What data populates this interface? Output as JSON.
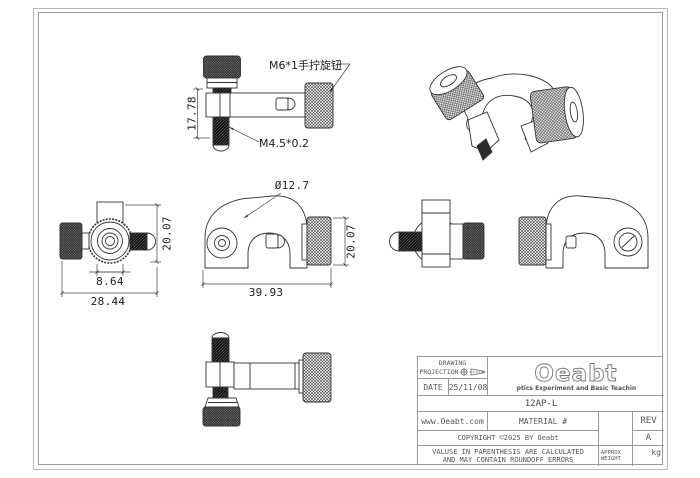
{
  "sheet": {
    "colors": {
      "line": "#333333",
      "frame": "#9a9a9a",
      "titleblock_text": "#555555"
    }
  },
  "drawing": {
    "callouts": {
      "thumb_screw": "M6*1手拧旋钮",
      "set_screw": "M4.5*0.2",
      "bore_diameter": "Ø12.7"
    },
    "dimensions": {
      "side_height": "17.78",
      "top_height": "20.07",
      "top_hub_width": "8.64",
      "top_total_width": "28.44",
      "front_knob_height": "20.07",
      "front_total_width": "39.93"
    }
  },
  "title_block": {
    "drawing_label": "DRAWING",
    "projection_label": "PROJECTION",
    "date_label": "DATE",
    "date_value": "25/11/08",
    "logo_text": "Oeabt",
    "logo_tagline": "Optics Experiment and Basic Teaching",
    "part_number": "12AP-L",
    "website": "www.Oeabt.com",
    "material_label": "MATERIAL #",
    "rev_label": "REV",
    "rev_value": "A",
    "copyright_text": "COPYRIGHT ©2025 BY Oeabt",
    "disclaimer_line1": "VALUSE IN PARENTHESIS ARE CALCULATED",
    "disclaimer_line2": "AND MAY CONTAIN ROUNDOFF ERRORS",
    "weight_label_line1": "APPROX",
    "weight_label_line2": "WEIGHT",
    "weight_unit": "kg"
  }
}
